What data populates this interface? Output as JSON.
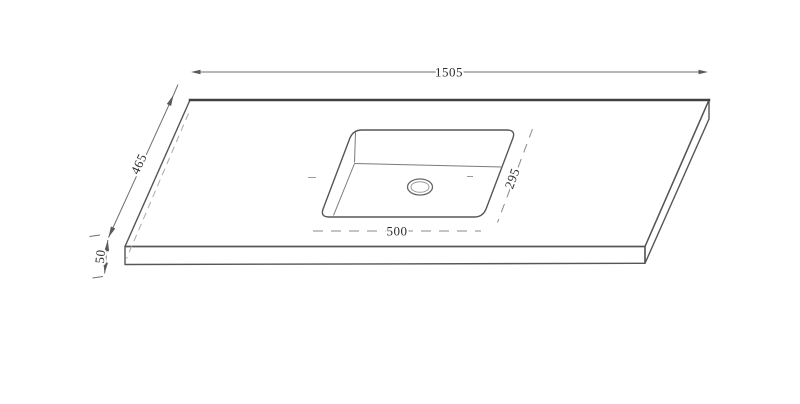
{
  "drawing": {
    "dimensions": {
      "overall_width": "1505",
      "overall_depth": "465",
      "thickness": "50",
      "sink_width": "500",
      "sink_depth": "295"
    },
    "colors": {
      "background": "#ffffff",
      "outline": "#565656",
      "hidden_edge": "#aaaaaa",
      "dimension_line": "#6f6f6f",
      "text": "#2e2e2e"
    }
  }
}
